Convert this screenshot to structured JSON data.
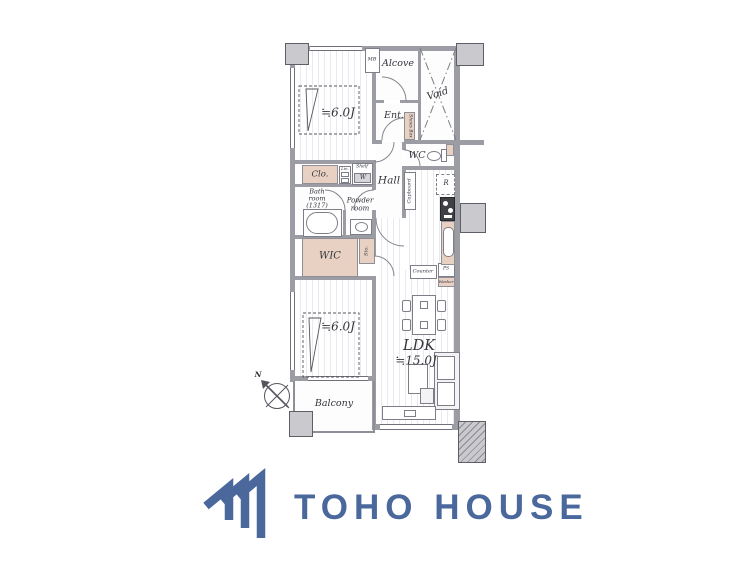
{
  "brand": {
    "name": "TOHO HOUSE",
    "color": "#4a689c"
  },
  "plan": {
    "labels": {
      "bedroom1": "≒6.0J",
      "bedroom2": "≒6.0J",
      "ldk": "LDK",
      "ldk_size": "≒15.0J",
      "alcove": "Alcove",
      "void": "Void",
      "entrance": "Ent.",
      "hall": "Hall",
      "wc": "WC",
      "bath": "Bath\nroom\n(1317)",
      "powder": "Powder\nroom",
      "closet": "Clo.",
      "linen": "Lin.",
      "shelf": "Shelf",
      "washer_symbol": "W",
      "wic": "WIC",
      "storage": "Sto.",
      "cupboard": "Cupboard",
      "shoes_box": "Shoes Box",
      "meter_box": "MB",
      "refrigerator": "R",
      "counter": "Counter",
      "pipe_space": "PS",
      "washer": "Washer",
      "balcony": "Balcony",
      "north": "N"
    },
    "colors": {
      "wall": "#9c9ca4",
      "accent_tan": "#e8d1c2",
      "pillar": "#c9c9ce"
    }
  }
}
